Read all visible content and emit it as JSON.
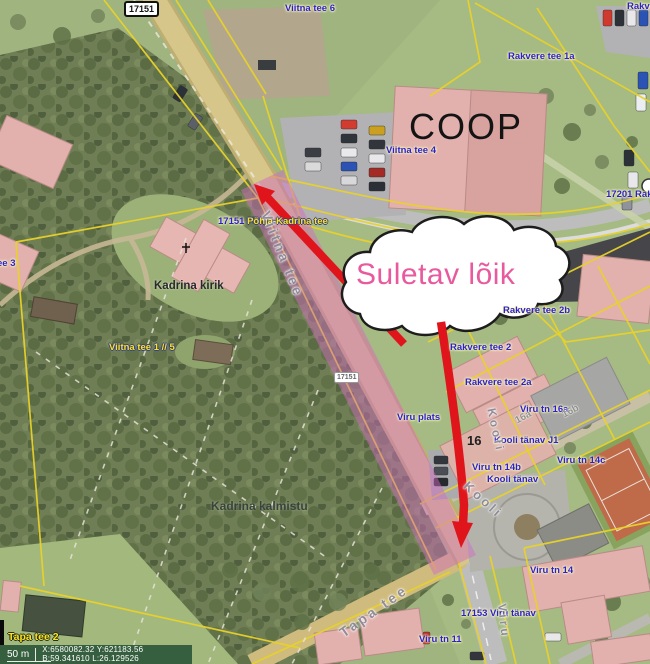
{
  "map": {
    "shields": {
      "top_17151": "17151",
      "mid_17151": "17151"
    },
    "labels": {
      "viitna_tee_6": "Viitna tee 6",
      "rakvere_clipped": "Rakve",
      "rakvere_tee_1a": "Rakvere tee 1a",
      "viitna_tee_4": "Viitna tee 4",
      "road_17201": "17201 Rakv",
      "phk_num": "17151",
      "phk_name": "Põhja-Kadrina tee",
      "viitna_tee_3_clipped": "ee 3",
      "rakvere_tee_2b": "Rakvere tee 2b",
      "viitna_tee_1_7_5": "Viitna tee 1 // 5",
      "rakvere_tee_2": "Rakvere tee 2",
      "rakvere_tee_2a": "Rakvere tee 2a",
      "viru_plats": "Viru plats",
      "viru_tn_16a": "Viru tn 16a",
      "kooli_tanav_j1": "Kooli tänav J1",
      "viru_tn_14b": "Viru tn 14b",
      "kooli_tanav": "Kooli tänav",
      "viru_tn_14c": "Viru tn 14c",
      "viru_tn_14": "Viru tn 14",
      "road_17153": "17153 Viru tänav",
      "viru_tn_11": "Viru tn 11",
      "tapa_tee_2": "Tapa tee 2"
    },
    "place_names": {
      "coop": "COOP",
      "kadrina_kirik": "Kadrina kirik",
      "kadrina_kalmistu": "Kadrina kalmistu"
    },
    "street_names": {
      "viitna_tee": "Viitna tee",
      "kooli_a": "Kooli",
      "kooli_b": "Kooli",
      "tapa_tee": "Tapa tee",
      "viru": "Viru"
    },
    "house_numbers": {
      "n16": "16",
      "n16a": "16a",
      "n16b": "16b"
    }
  },
  "annotation": {
    "closed_section_label": "Suletav lõik",
    "text_color": "#e8599e",
    "arrow_color": "#e0151c",
    "highlight_color": "#d06ac0"
  },
  "status_bar": {
    "scale": "50 m",
    "coord_xy": "X:6580082.32 Y:621183.56",
    "coord_bl": "B:59.341610 L:26.129526"
  },
  "colors": {
    "label_blue": "#2b1fd4",
    "label_yellow": "#ffe21a",
    "cadastral_line": "#e8d22a"
  }
}
